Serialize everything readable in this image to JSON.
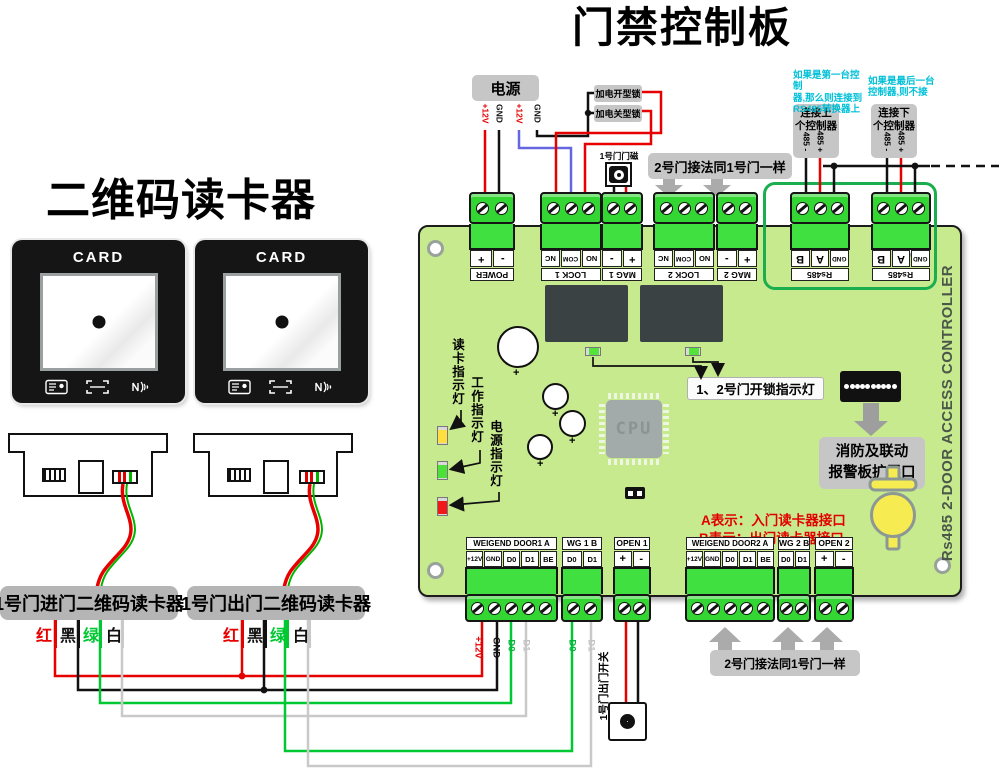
{
  "title": "门禁控制板",
  "reader_title": "二维码读卡器",
  "card_label": "CARD",
  "reader_labels": [
    "1号门进门二维码读卡器",
    "1号门出门二维码读卡器"
  ],
  "legend": [
    "红",
    "黑",
    "绿",
    "白"
  ],
  "power": {
    "title": "电源",
    "pins": [
      "+12V",
      "GND",
      "+12V",
      "GND"
    ]
  },
  "locks": {
    "power_on_open": "加电开型锁",
    "power_on_close": "加电关型锁"
  },
  "mag_button": "1号门门磁",
  "door2_note_top": "2号门接法同1号门一样",
  "door2_note_bottom": "2号门接法同1号门一样",
  "rs485": {
    "note_first": "如果是第一台控制\n器,那么则连接到\nRS485转换器上",
    "note_last": "如果是最后一台\n控制器,则不接",
    "connect_up": "连接上\n个控制器",
    "connect_down": "连接下\n个控制器",
    "pin_minus": "485 -",
    "pin_plus": "485 +"
  },
  "terminals_top": [
    {
      "name": "POWER",
      "cells": [
        "+",
        "-"
      ]
    },
    {
      "name": "LOCK 1",
      "cells": [
        "NC",
        "COM",
        "NO"
      ]
    },
    {
      "name": "MAG 1",
      "cells": [
        "-",
        "+"
      ]
    },
    {
      "name": "LOCK 2",
      "cells": [
        "NC",
        "COM",
        "NO"
      ]
    },
    {
      "name": "MAG 2",
      "cells": [
        "-",
        "+"
      ]
    },
    {
      "name": "Rs485",
      "cells": [
        "B",
        "A",
        "GND"
      ]
    },
    {
      "name": "Rs485",
      "cells": [
        "B",
        "A",
        "GND"
      ]
    }
  ],
  "terminals_bottom": [
    {
      "name": "WEIGEND DOOR1 A",
      "cells": [
        "+12V",
        "GND",
        "D0",
        "D1",
        "BE"
      ]
    },
    {
      "name": "WG 1 B",
      "cells": [
        "D0",
        "D1"
      ]
    },
    {
      "name": "OPEN 1",
      "cells": [
        "+",
        "-"
      ]
    },
    {
      "name": "WEIGEND DOOR2 A",
      "cells": [
        "+12V",
        "GND",
        "D0",
        "D1",
        "BE"
      ]
    },
    {
      "name": "WG 2 B",
      "cells": [
        "D0",
        "D1"
      ]
    },
    {
      "name": "OPEN 2",
      "cells": [
        "+",
        "-"
      ]
    }
  ],
  "board": {
    "indicators": [
      "读卡指示灯",
      "工作指示灯",
      "电源指示灯"
    ],
    "unlock_note": "1、2号门开锁指示灯",
    "cpu": "CPU",
    "fire_box": "消防及联动\n报警板扩展口",
    "a_note": "A表示：入门读卡器接口",
    "b_note": "B表示：出门读卡器接口",
    "side_text": "Rs485 2-DOOR ACCESS CONTROLLER"
  },
  "exit_switch": "1号门出门开关",
  "wire_labels": {
    "v12": "+12V",
    "gnd": "GND",
    "d0": "D0",
    "d1": "D1"
  },
  "colors": {
    "board": "#c7ea8e",
    "terminal": "#3fe03f",
    "wire_red": "#e60000",
    "wire_black": "#111111",
    "wire_green": "#00c832",
    "wire_white": "#c9c9c9",
    "wire_blue": "#6666e0",
    "accent_cyan": "#00c0d8",
    "note_red": "#e30000",
    "led_yellow": "#ffdf3f",
    "led_green": "#4ee03a",
    "led_red": "#f01818",
    "arrow_gray": "#ababab"
  }
}
